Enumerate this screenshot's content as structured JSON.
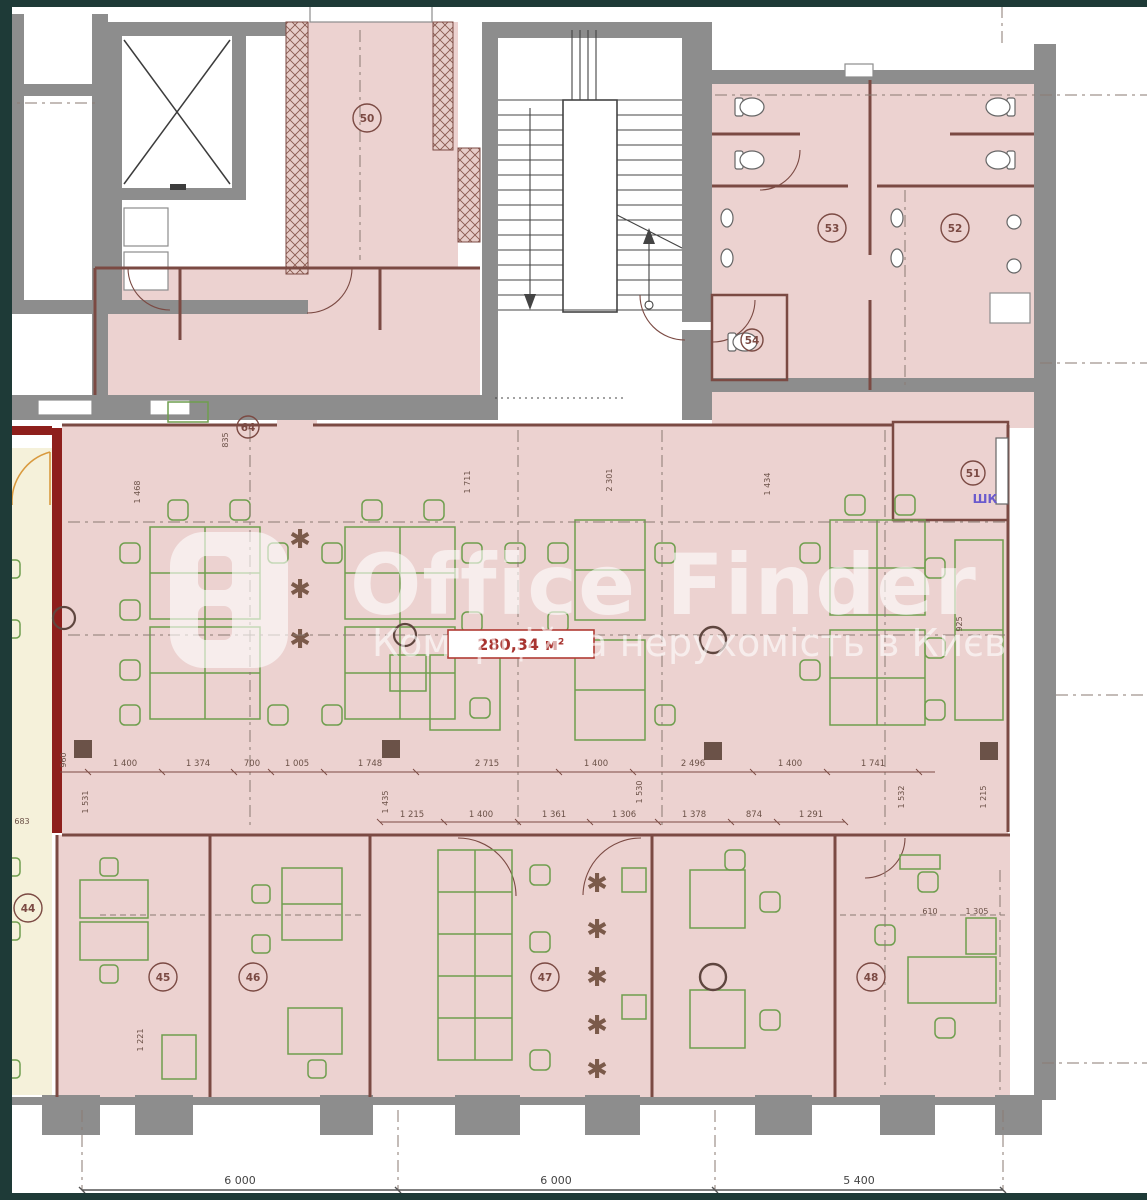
{
  "watermark": {
    "brand": "Office Finder",
    "tagline": "Комерційна нерухомість в Києві"
  },
  "area_label": "280,34 м²",
  "wardrobe_label": "ШК",
  "rooms": {
    "r44": "44",
    "r45": "45",
    "r46": "46",
    "r47": "47",
    "r48": "48",
    "r50": "50",
    "r51": "51",
    "r52": "52",
    "r53": "53",
    "r54": "54",
    "r64": "64"
  },
  "dims": {
    "row1": [
      "1 400",
      "1 374",
      "700",
      "1 005",
      "1 748",
      "2 715",
      "1 400",
      "2 496",
      "1 400",
      "1 741"
    ],
    "row2": [
      "1 215",
      "1 400",
      "1 361",
      "1 306",
      "1 378",
      "874",
      "1 291"
    ],
    "bottom": [
      "6 000",
      "6 000",
      "5 400"
    ],
    "vertical": [
      "960",
      "1 468",
      "835",
      "1 711",
      "2 301",
      "1 434",
      "925",
      "1 531",
      "1 435",
      "1 530",
      "1 532",
      "1 215",
      "1 221",
      "683"
    ],
    "small": [
      "610",
      "1 305"
    ]
  },
  "colors": {
    "offer_fill": "#ecd2d0",
    "adjacent_fill": "#f5f1da",
    "wall_gray": "#8d8d8d",
    "wall_maroon": "#7b4a43",
    "furniture_green": "#6f9e4e",
    "accent_red_wall": "#8e1f1c",
    "frame_dark": "#1e3a37",
    "area_label_red": "#a83430",
    "wardrobe_purple": "#6a5acd",
    "dimension_text": "#6b5147"
  }
}
